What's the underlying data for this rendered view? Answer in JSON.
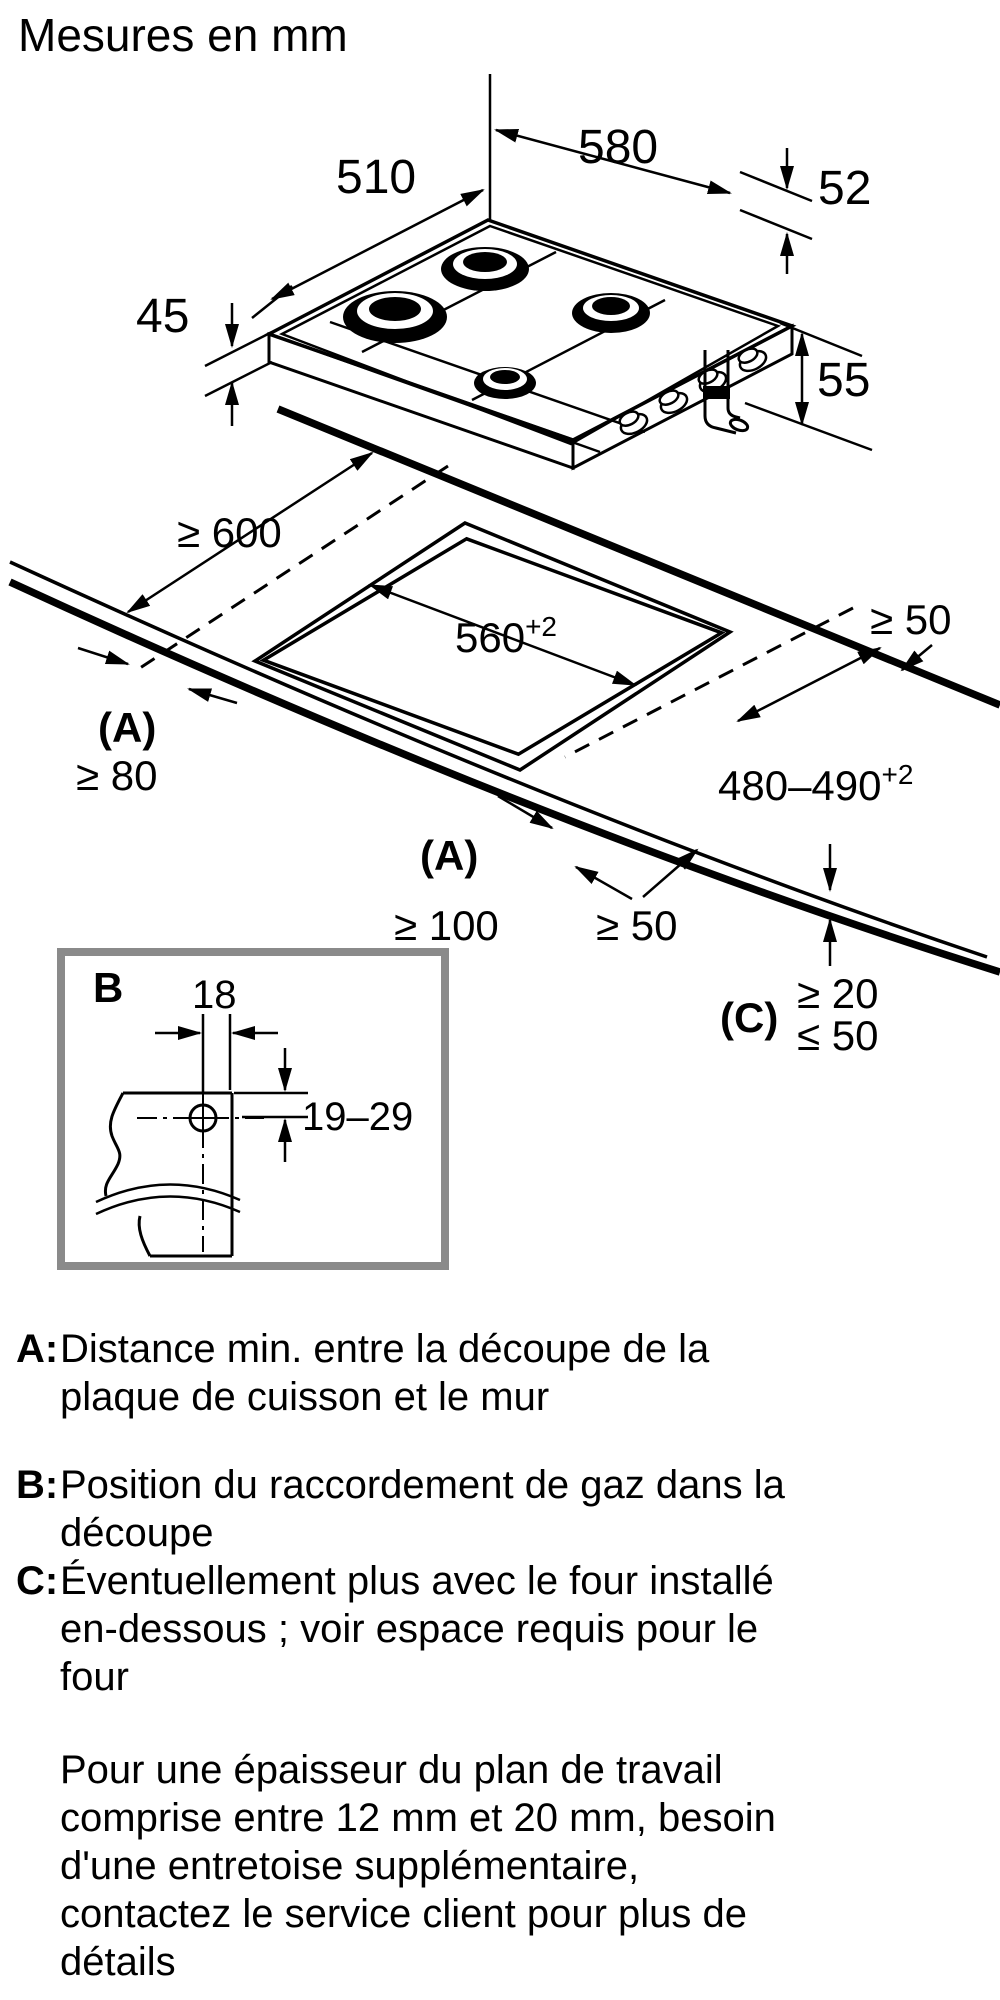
{
  "title": "Mesures en mm",
  "hob_dims": {
    "depth": "510",
    "width": "580",
    "rim_height": "52",
    "front_height": "45",
    "pipe_clearance": "55"
  },
  "install": {
    "back_clearance": "≥ 600",
    "side_gap_right": "≥ 50",
    "cutout_width": "560",
    "cutout_width_tol": "+2",
    "wall_label_left": "(A)",
    "wall_min_left": "≥ 80",
    "cutout_depth": "480–490",
    "cutout_depth_tol": "+2",
    "wall_label_front": "(A)",
    "wall_min_front": "≥ 100",
    "front_gap": "≥ 50",
    "edge_label": "(C)",
    "edge_min": "≥ 20",
    "edge_max": "≤ 50"
  },
  "detail_b": {
    "label": "B",
    "gas_offset": "18",
    "gas_depth": "19–29"
  },
  "legend": [
    {
      "key": "A:",
      "text": "Distance min. entre la découpe de la\nplaque de cuisson et le mur"
    },
    {
      "key": "B:",
      "text": "Position du raccordement de gaz dans la\ndécoupe"
    },
    {
      "key": "C:",
      "text": "Éventuellement plus avec le four installé\nen-dessous ; voir espace requis pour le\nfour"
    }
  ],
  "note": "Pour une épaisseur du plan de travail\ncomprise entre 12 mm et 20 mm, besoin\nd'une entretoise supplémentaire,\ncontactez le service client pour plus de\ndétails"
}
